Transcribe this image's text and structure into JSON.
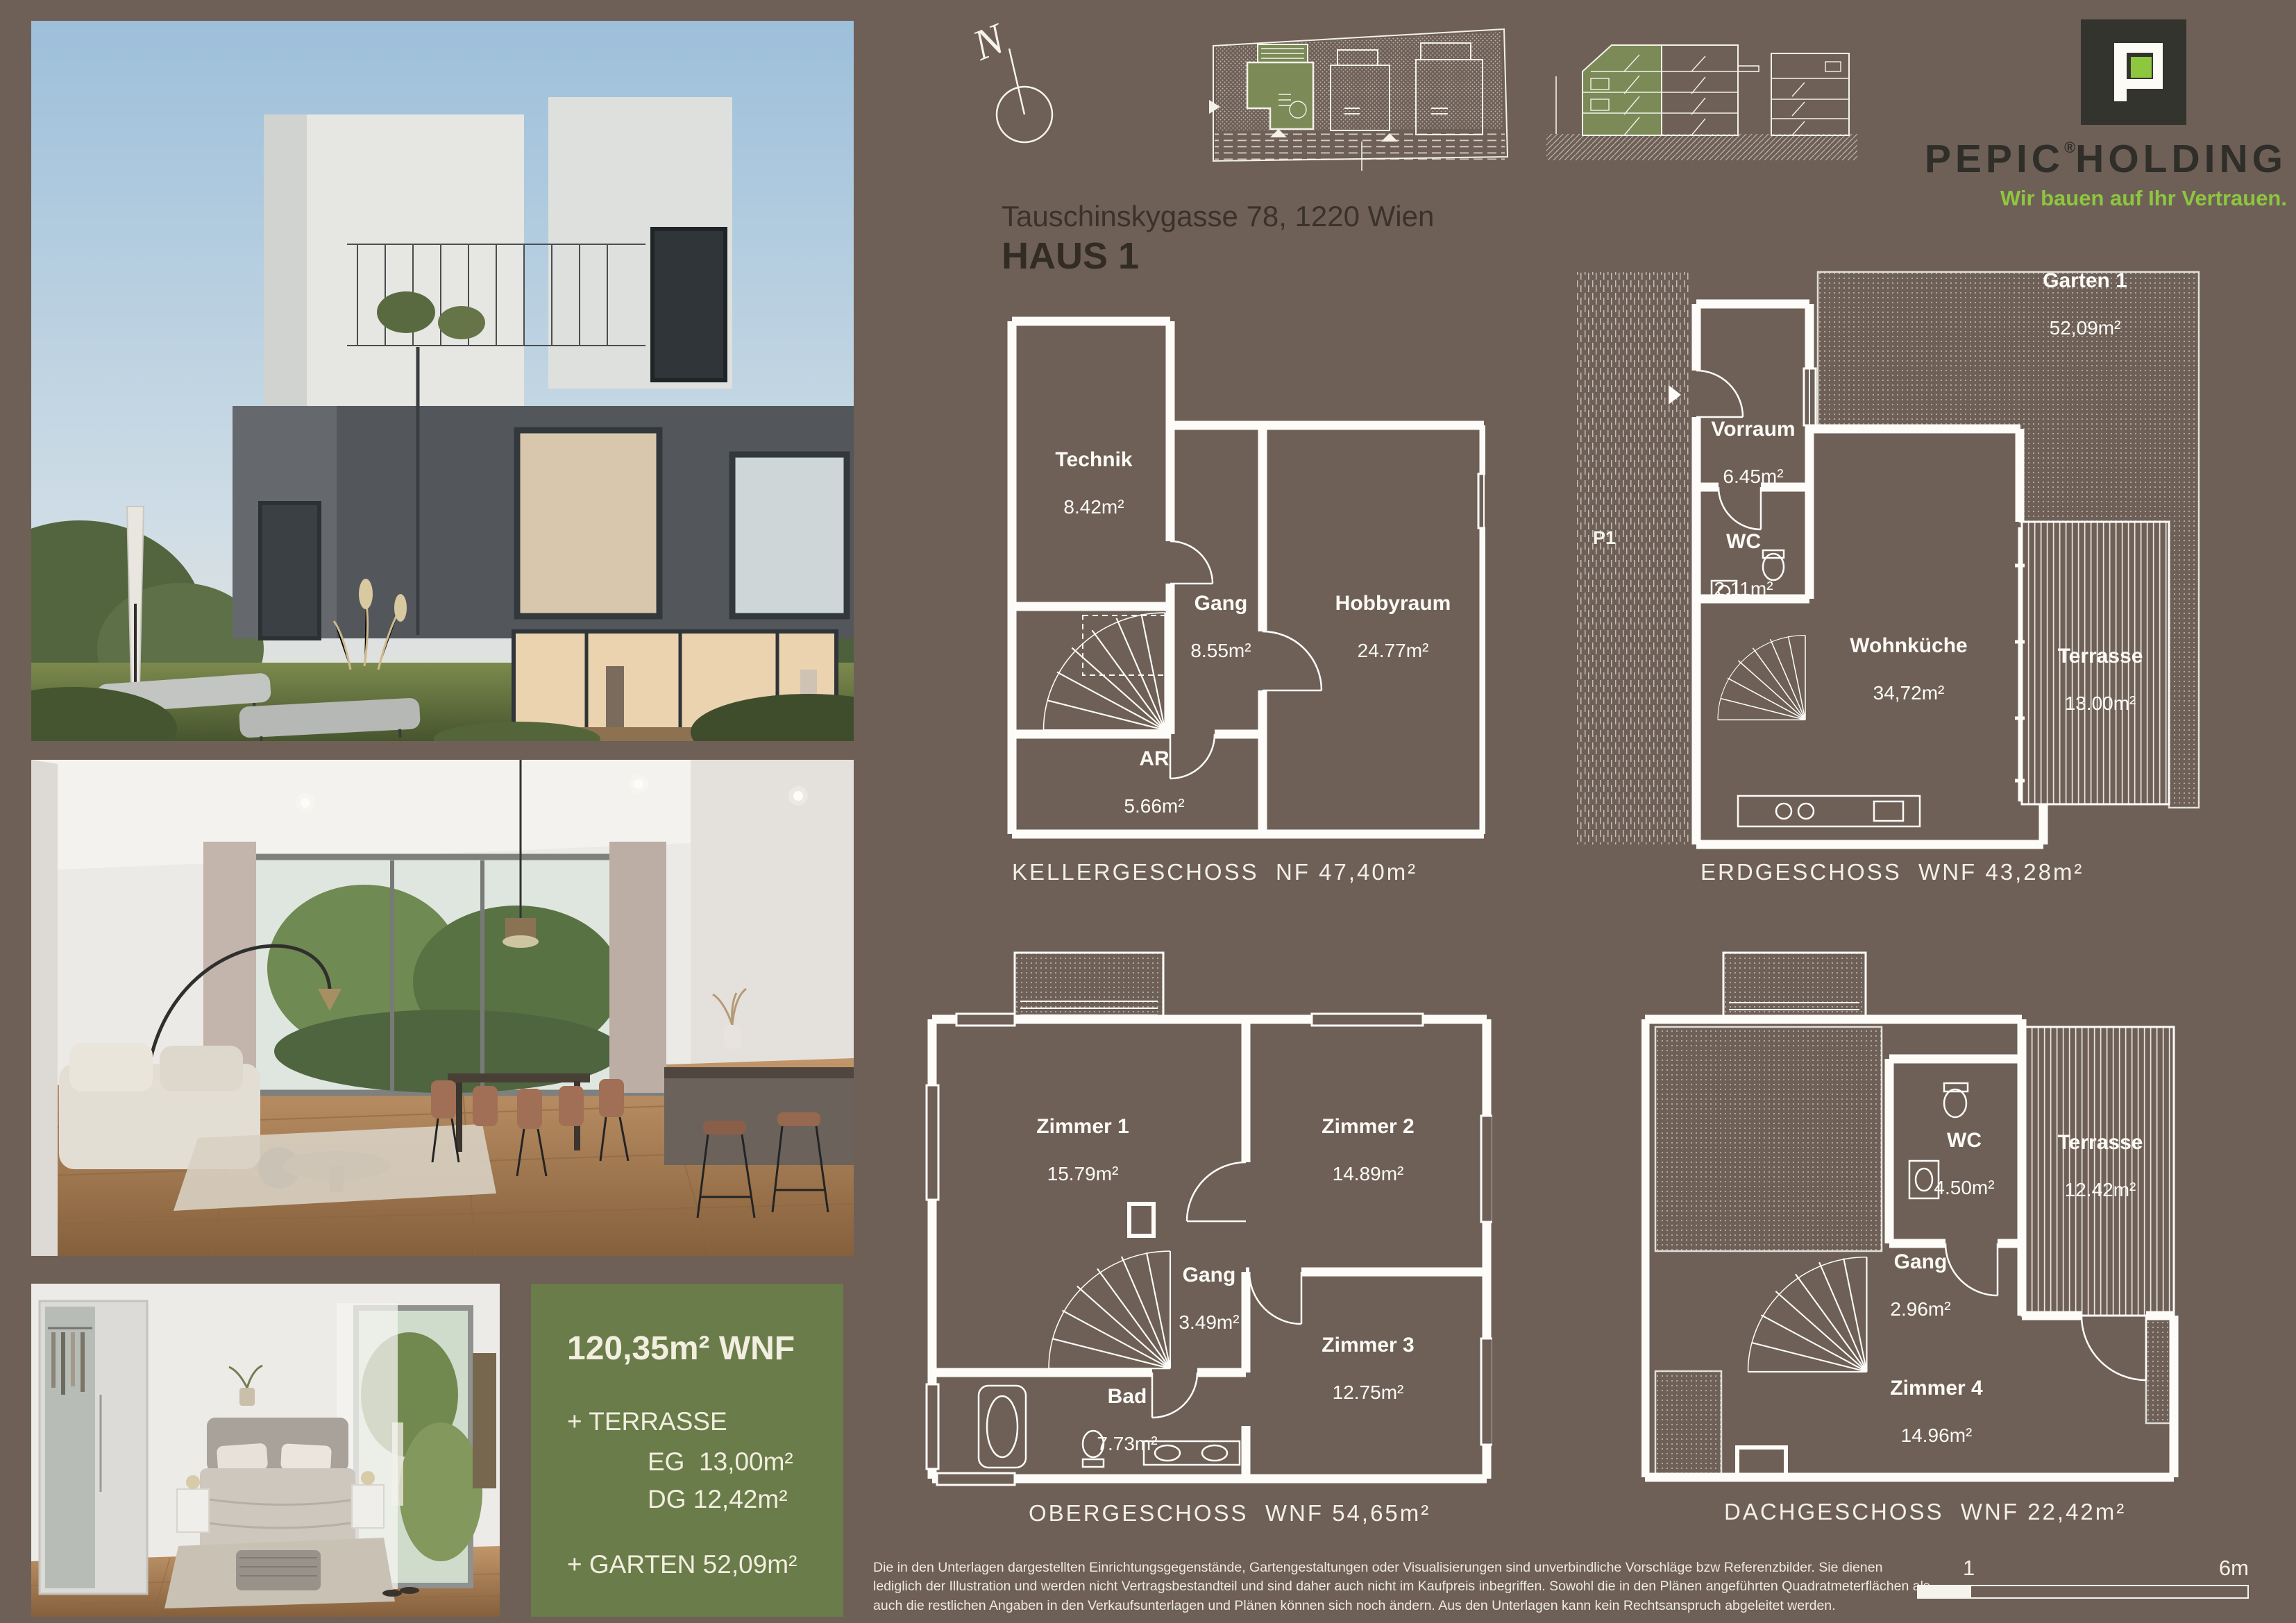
{
  "page": {
    "background": "#6e6057",
    "accent_green": "#8dc63f",
    "box_green": "#6a7c49"
  },
  "header": {
    "address": "Tauschinskygasse 78, 1220 Wien",
    "house": "HAUS 1",
    "compass_label": "N"
  },
  "logo": {
    "brand": "PEPIC",
    "reg": "®",
    "brand2": "HOLDING",
    "tagline": "Wir bauen auf Ihr Vertrauen."
  },
  "summary": {
    "wnf": "120,35m² WNF",
    "terrasse": "+ TERRASSE",
    "eg": "EG  13,00m²",
    "dg": "DG 12,42m²",
    "garten": "+ GARTEN 52,09m²"
  },
  "plans": {
    "kg": {
      "caption": "KELLERGESCHOSS  NF 47,40m²",
      "rooms": [
        {
          "name": "Technik",
          "area": "8.42m²"
        },
        {
          "name": "Gang",
          "area": "8.55m²"
        },
        {
          "name": "Hobbyraum",
          "area": "24.77m²"
        },
        {
          "name": "AR",
          "area": "5.66m²"
        }
      ]
    },
    "eg": {
      "caption": "ERDGESCHOSS  WNF 43,28m²",
      "parking": "P1",
      "rooms": [
        {
          "name": "Garten 1",
          "area": "52,09m²"
        },
        {
          "name": "Vorraum",
          "area": "6.45m²"
        },
        {
          "name": "WC",
          "area": "2.11m²"
        },
        {
          "name": "Wohnküche",
          "area": "34,72m²"
        },
        {
          "name": "Terrasse",
          "area": "13.00m²"
        }
      ]
    },
    "og": {
      "caption": "OBERGESCHOSS  WNF 54,65m²",
      "rooms": [
        {
          "name": "Zimmer 1",
          "area": "15.79m²"
        },
        {
          "name": "Zimmer 2",
          "area": "14.89m²"
        },
        {
          "name": "Gang",
          "area": "3.49m²"
        },
        {
          "name": "Zimmer 3",
          "area": "12.75m²"
        },
        {
          "name": "Bad",
          "area": "7.73m²"
        }
      ]
    },
    "dg": {
      "caption": "DACHGESCHOSS  WNF 22,42m²",
      "rooms": [
        {
          "name": "WC",
          "area": "4.50m²"
        },
        {
          "name": "Terrasse",
          "area": "12.42m²"
        },
        {
          "name": "Gang",
          "area": "2.96m²"
        },
        {
          "name": "Zimmer 4",
          "area": "14.96m²"
        }
      ]
    }
  },
  "scalebar": {
    "tick1": "1",
    "tick2": "6m"
  },
  "disclaimer": "Die in den Unterlagen dargestellten Einrichtungsgegenstände, Gartengestaltungen oder Visualisierungen sind unverbindliche Vorschläge bzw Referenzbilder. Sie dienen lediglich der Illustration und werden nicht Vertragsbestandteil und sind daher auch nicht im Kaufpreis inbegriffen. Sowohl die in den Plänen angeführten Quadratmeterflächen als auch die restlichen Angaben in den Verkaufsunterlagen und Plänen können sich noch ändern. Aus den Unterlagen kann kein Rechtsanspruch abgeleitet werden."
}
